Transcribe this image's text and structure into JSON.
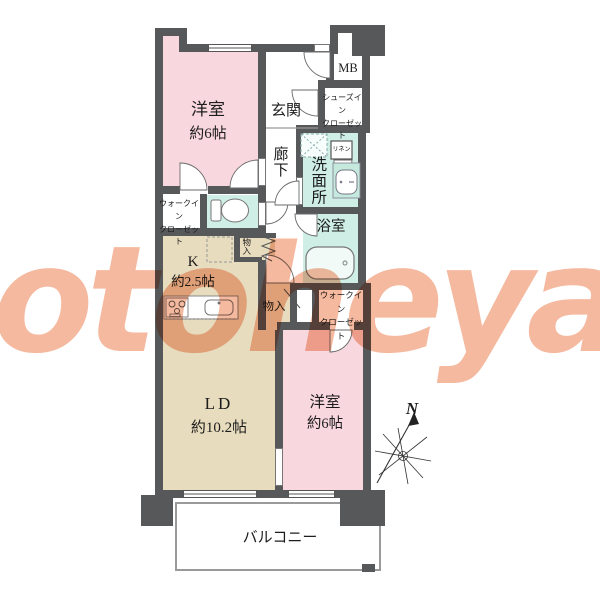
{
  "watermark": {
    "text": "otoheya"
  },
  "compass": {
    "north": "N"
  },
  "colors": {
    "wall": "#57585a",
    "bedroom_pink": "#f8d7de",
    "ld_beige": "#e8dcbe",
    "wet_area_mint": "#cfeee5",
    "watermark_salmon": "#ef8e63"
  },
  "rooms": {
    "bedroom_top": {
      "name": "洋室",
      "size": "約6帖"
    },
    "entrance": {
      "label": "玄関"
    },
    "shoes_in_closet": {
      "line1": "シューズイン",
      "line2": "クローゼット"
    },
    "meter_box": {
      "label": "MB"
    },
    "hallway": {
      "label": "廊下"
    },
    "washroom": {
      "label": "洗面所"
    },
    "linen_closet": {
      "label": "リネン"
    },
    "walk_in_closet_left": {
      "line1": "ウォークイン",
      "line2": "クローゼット"
    },
    "storage_upper": {
      "label": "物入"
    },
    "kitchen": {
      "name": "K",
      "size": "約2.5帖"
    },
    "bathroom": {
      "label": "浴室"
    },
    "storage_lower": {
      "label": "物入"
    },
    "walk_in_closet_right": {
      "line1": "ウォークイン",
      "line2": "クローゼット"
    },
    "living_dining": {
      "name": "LD",
      "size": "約10.2帖"
    },
    "bedroom_bottom": {
      "name": "洋室",
      "size": "約6帖"
    },
    "balcony": {
      "label": "バルコニー"
    }
  },
  "icons": [
    "toilet-icon",
    "bathtub-icon",
    "washbasin-icon",
    "stove-icon",
    "kitchen-sink-icon",
    "washer-space-icon",
    "fridge-space-icon",
    "linen-door-icon",
    "door-arc-icon",
    "folding-door-icon",
    "compass-icon"
  ]
}
